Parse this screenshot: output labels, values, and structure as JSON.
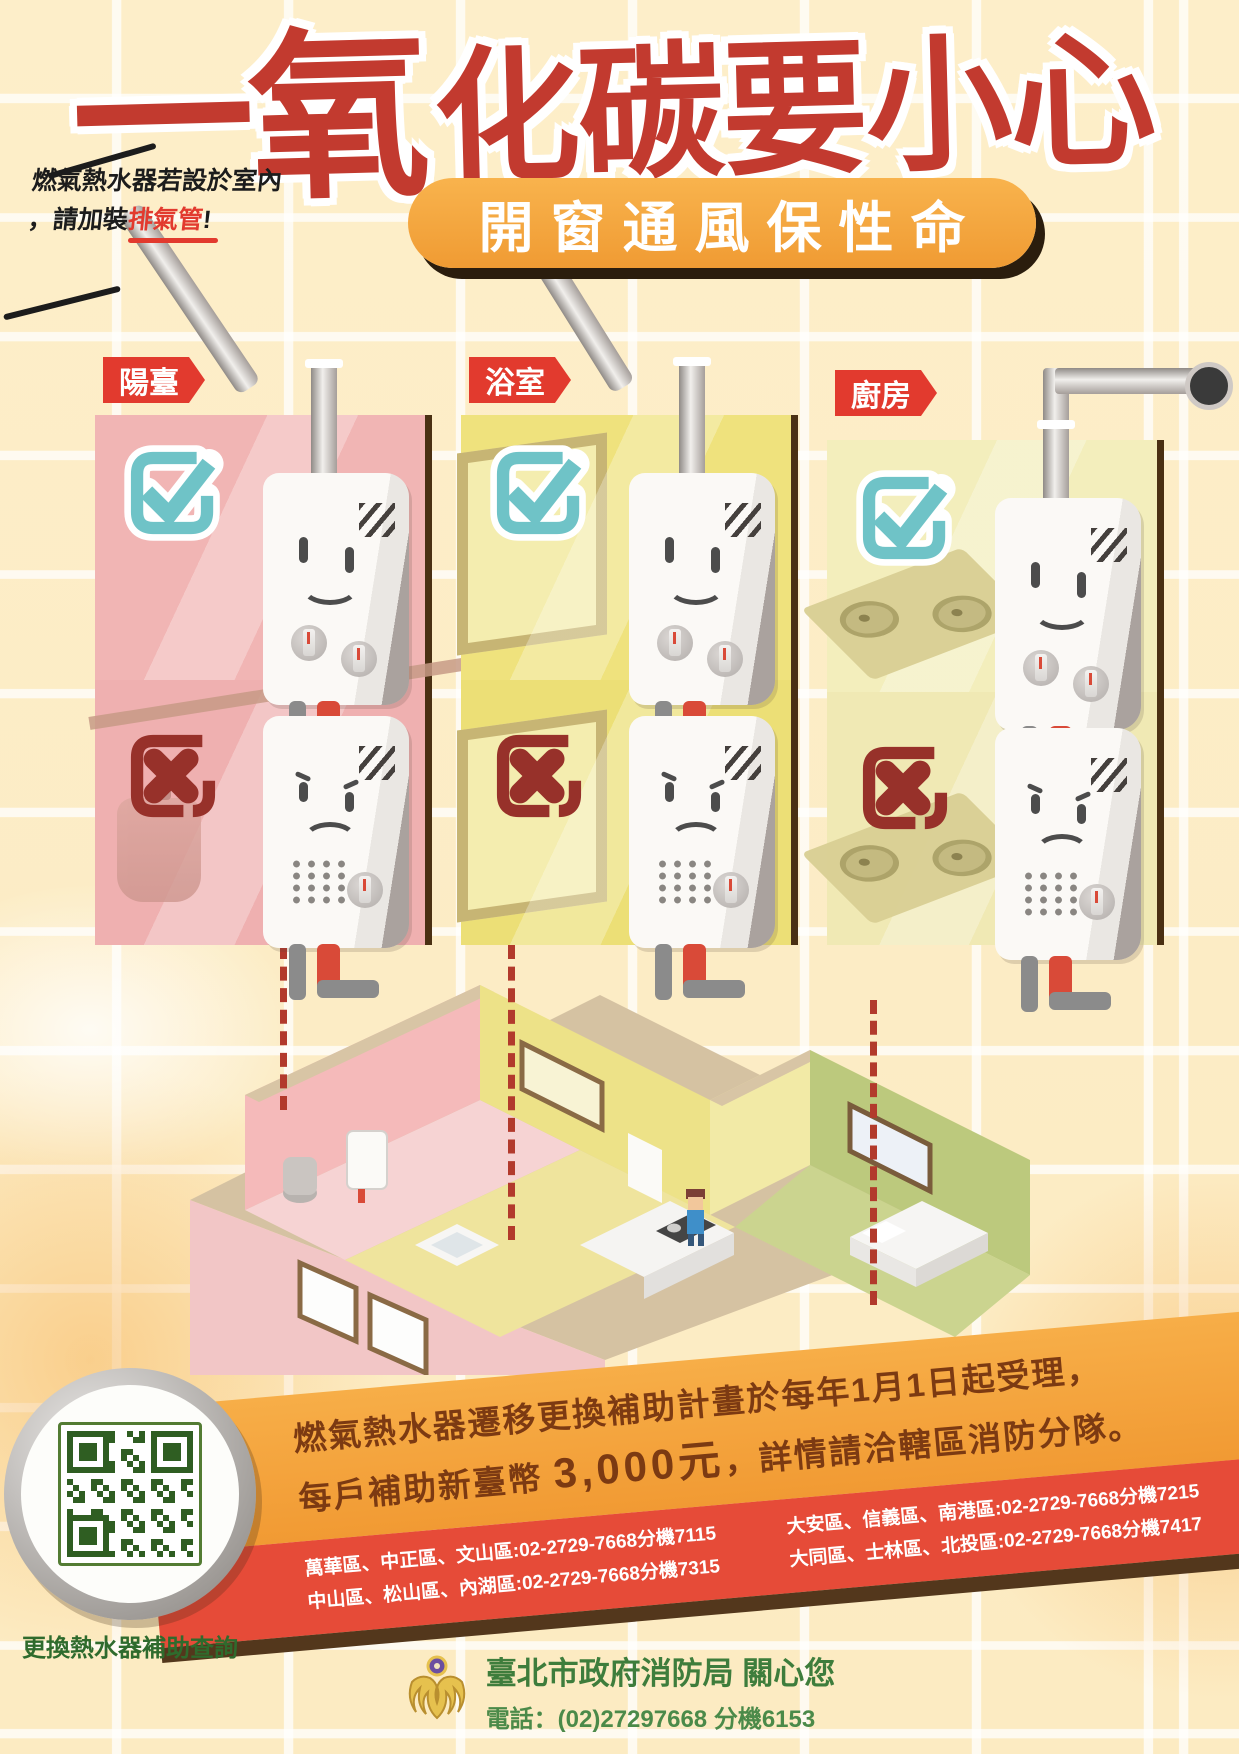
{
  "header": {
    "title_lead": "一氧",
    "title_rest": "化碳要小心",
    "note_line1": "燃氣熱水器若設於室內",
    "note_line2_prefix": "，請加裝",
    "note_line2_highlight": "排氣管",
    "note_line2_suffix": "!",
    "slogan": "開窗通風保性命"
  },
  "panels": [
    {
      "label": "陽臺"
    },
    {
      "label": "浴室"
    },
    {
      "label": "廚房"
    }
  ],
  "subsidy": {
    "line1": "燃氣熱水器遷移更換補助計畫於每年1月1日起受理，",
    "line2_prefix": "每戶補助新臺幣 ",
    "amount": "3,000元",
    "line2_suffix": "，詳情請洽轄區消防分隊。",
    "district_columns": [
      {
        "row1": "萬華區、中正區、文山區:02-2729-7668分機7115",
        "row2": "中山區、松山區、內湖區:02-2729-7668分機7315"
      },
      {
        "row1": "大安區、信義區、南港區:02-2729-7668分機7215",
        "row2": "大同區、士林區、北投區:02-2729-7668分機7417"
      }
    ]
  },
  "qr_section": {
    "label": "更換熱水器補助查詢"
  },
  "footer": {
    "org": "臺北市政府消防局 關心您",
    "phone": "電話：(02)27297668 分機6153"
  },
  "colors": {
    "title_red": "#c23a2f",
    "slogan_orange": "#f5a53f",
    "label_red": "#e23a2e",
    "check_teal": "#6fc3c7",
    "cross_maroon": "#97312a",
    "subsidy_text_brown": "#7c3a12",
    "district_strip_red": "#e64b38",
    "footer_green": "#3e7d3c",
    "qr_green": "#2f5e22"
  }
}
